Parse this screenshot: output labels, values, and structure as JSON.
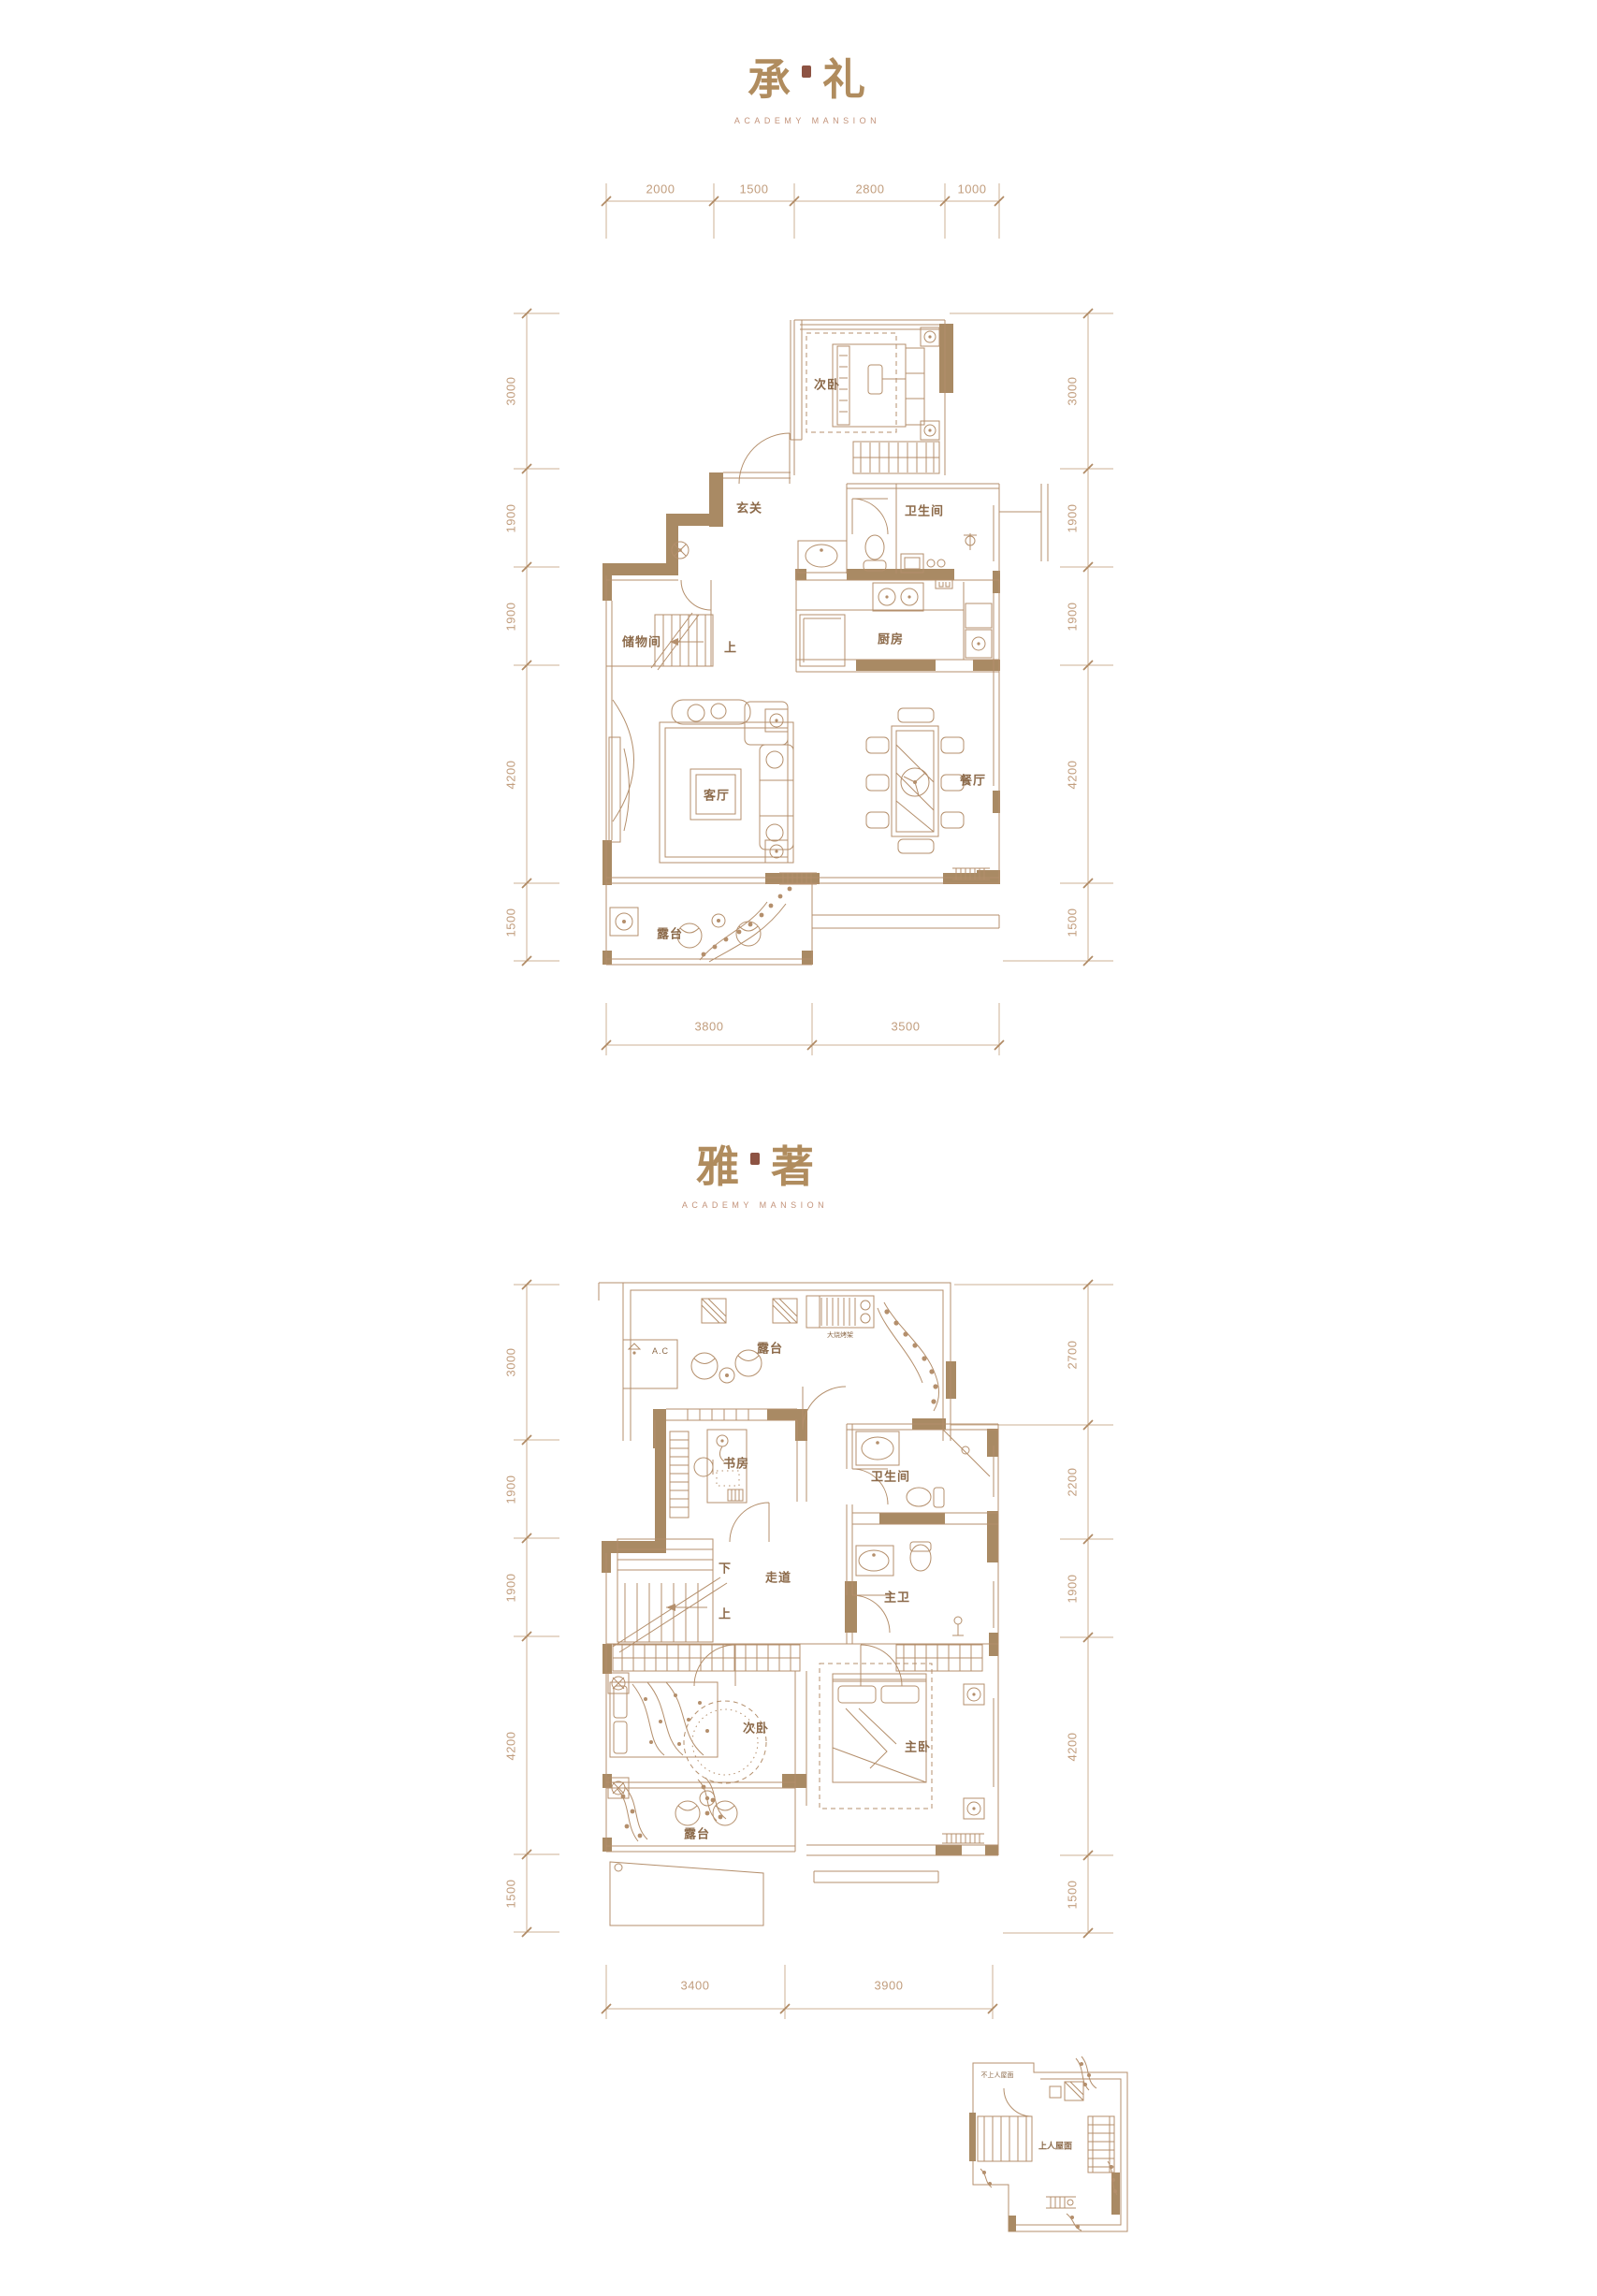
{
  "colors": {
    "line": "#b48f6c",
    "wall_fill": "#a98a64",
    "dimension_line": "#cdb296",
    "dimension_text": "#c19d7d",
    "room_label": "#8c6a4a",
    "title_text": "#b08c5e",
    "subtitle_text": "#c3937a",
    "seal": "#8d5343",
    "background": "#ffffff"
  },
  "plan1": {
    "title": {
      "char_left": "承",
      "char_right": "礼",
      "subtitle": "ACADEMY MANSION"
    },
    "dims": {
      "top": [
        "2000",
        "1500",
        "2800",
        "1000"
      ],
      "bottom": [
        "3800",
        "3500"
      ],
      "left": [
        "3000",
        "1900",
        "1900",
        "4200",
        "1500"
      ],
      "right": [
        "3000",
        "1900",
        "1900",
        "4200",
        "1500"
      ]
    },
    "rooms": {
      "bedroom2": "次卧",
      "foyer": "玄关",
      "bathroom": "卫生间",
      "storage": "储物间",
      "stairs_up": "上",
      "kitchen": "厨房",
      "living": "客厅",
      "dining": "餐厅",
      "terrace": "露台"
    }
  },
  "plan2": {
    "title": {
      "char_left": "雅",
      "char_right": "著",
      "subtitle": "ACADEMY MANSION"
    },
    "dims": {
      "bottom": [
        "3400",
        "3900"
      ],
      "left": [
        "3000",
        "1900",
        "1900",
        "4200",
        "1500"
      ],
      "right": [
        "2700",
        "2200",
        "1900",
        "4200",
        "1500"
      ]
    },
    "rooms": {
      "terrace_top": "露台",
      "ac_unit": "A.C",
      "bbq": "大烧烤架",
      "study": "书房",
      "bathroom": "卫生间",
      "stairs_down": "下",
      "corridor": "走道",
      "stairs_up": "上",
      "master_bath": "主卫",
      "bedroom2": "次卧",
      "master_bedroom": "主卧",
      "terrace_bottom": "露台"
    }
  },
  "roof_plan": {
    "non_accessible": "不上人屋面",
    "accessible": "上人屋面"
  }
}
